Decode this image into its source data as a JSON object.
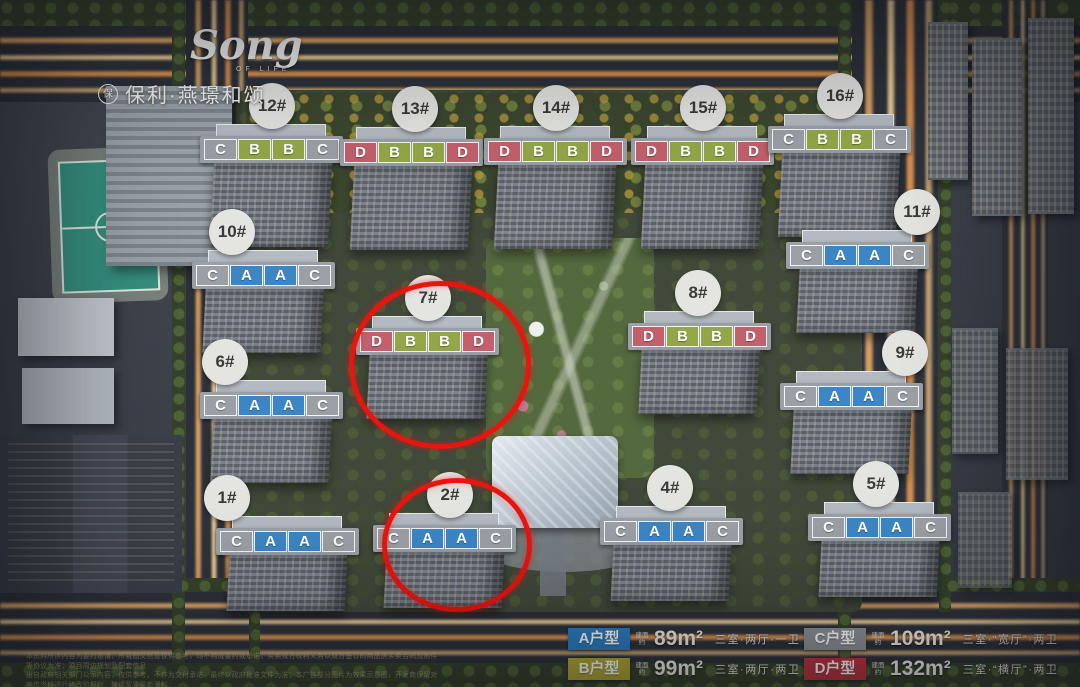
{
  "brand": {
    "script": "Song",
    "script_sub": "OF LIFE",
    "logo_mark": "保",
    "name": "保利·燕璟和颂"
  },
  "map": {
    "unit_colors": {
      "A": "#3c86c5",
      "B": "#93a748",
      "C": "#9aa0a6",
      "D": "#c2606c"
    },
    "highlight_color": "#e8150f",
    "buildings": [
      {
        "no": "12#",
        "units": [
          "C",
          "B",
          "B",
          "C"
        ],
        "x": 272,
        "y": 150,
        "row": "top",
        "circle_dx": 0,
        "circled": false
      },
      {
        "no": "13#",
        "units": [
          "D",
          "B",
          "B",
          "D"
        ],
        "x": 412,
        "y": 153,
        "row": "top",
        "circle_dx": 3,
        "circled": false
      },
      {
        "no": "14#",
        "units": [
          "D",
          "B",
          "B",
          "D"
        ],
        "x": 556,
        "y": 152,
        "row": "top",
        "circle_dx": 0,
        "circled": false
      },
      {
        "no": "15#",
        "units": [
          "D",
          "B",
          "B",
          "D"
        ],
        "x": 703,
        "y": 152,
        "row": "top",
        "circle_dx": 0,
        "circled": false
      },
      {
        "no": "16#",
        "units": [
          "C",
          "B",
          "B",
          "C"
        ],
        "x": 840,
        "y": 140,
        "row": "top",
        "circle_dx": 0,
        "circled": false
      },
      {
        "no": "10#",
        "units": [
          "C",
          "A",
          "A",
          "C"
        ],
        "x": 264,
        "y": 276,
        "row": "mid",
        "circle_dx": -32,
        "circled": false
      },
      {
        "no": "11#",
        "units": [
          "C",
          "A",
          "A",
          "C"
        ],
        "x": 858,
        "y": 256,
        "row": "mid",
        "circle_dx": 59,
        "circled": false
      },
      {
        "no": "7#",
        "units": [
          "D",
          "B",
          "B",
          "D"
        ],
        "x": 428,
        "y": 342,
        "row": "mid",
        "circle_dx": 0,
        "circled": true
      },
      {
        "no": "8#",
        "units": [
          "D",
          "B",
          "B",
          "D"
        ],
        "x": 700,
        "y": 337,
        "row": "mid",
        "circle_dx": -2,
        "circled": false
      },
      {
        "no": "6#",
        "units": [
          "C",
          "A",
          "A",
          "C"
        ],
        "x": 272,
        "y": 406,
        "row": "mid",
        "circle_dx": -47,
        "circled": false
      },
      {
        "no": "9#",
        "units": [
          "C",
          "A",
          "A",
          "C"
        ],
        "x": 852,
        "y": 397,
        "row": "mid",
        "circle_dx": 53,
        "circled": false
      },
      {
        "no": "1#",
        "units": [
          "C",
          "A",
          "A",
          "C"
        ],
        "x": 288,
        "y": 542,
        "row": "bottom",
        "circle_dx": -61,
        "circled": false
      },
      {
        "no": "2#",
        "units": [
          "C",
          "A",
          "A",
          "C"
        ],
        "x": 445,
        "y": 539,
        "row": "bottom",
        "circle_dx": 5,
        "circled": true
      },
      {
        "no": "4#",
        "units": [
          "C",
          "A",
          "A",
          "C"
        ],
        "x": 672,
        "y": 532,
        "row": "bottom",
        "circle_dx": -2,
        "circled": false
      },
      {
        "no": "5#",
        "units": [
          "C",
          "A",
          "A",
          "C"
        ],
        "x": 880,
        "y": 528,
        "row": "bottom",
        "circle_dx": -4,
        "circled": false
      }
    ]
  },
  "legend": {
    "area_prefix": "建面约",
    "items": [
      {
        "code": "A",
        "label": "A户型",
        "color": "#2b7fc3",
        "area": "89m²",
        "desc": "三室·两厅·一卫"
      },
      {
        "code": "C",
        "label": "C户型",
        "color": "#8e9399",
        "area": "109m²",
        "desc": "三室·“宽厅”·两卫"
      },
      {
        "code": "B",
        "label": "B户型",
        "color": "#b3a935",
        "area": "99m²",
        "desc": "三室·两厅·两卫"
      },
      {
        "code": "D",
        "label": "D户型",
        "color": "#c0353f",
        "area": "132m²",
        "desc": "三室·“横厅”·两卫"
      }
    ]
  },
  "disclaimer": {
    "lines": [
      "本资料所涉内容为要约邀请，所载图文信息仅供参考，均不构成要约或承诺，买卖双方权利义务以双方签订的商品房买卖合同及附件等协议为准；项目周边规划及配套信息",
      "出自政府相关部门公示内容，仅供参考，不作为交付承诺，最终以政府批准文件为准；本广告部分图片为效果示意图，开发商保留对宣传资料进行修改的权利，敬请留意最新资料；",
      "相关户型建筑面积为预测面积，最终以实际交付为准；本资料制作时间为2022年，资料有效期至2022年。"
    ]
  }
}
